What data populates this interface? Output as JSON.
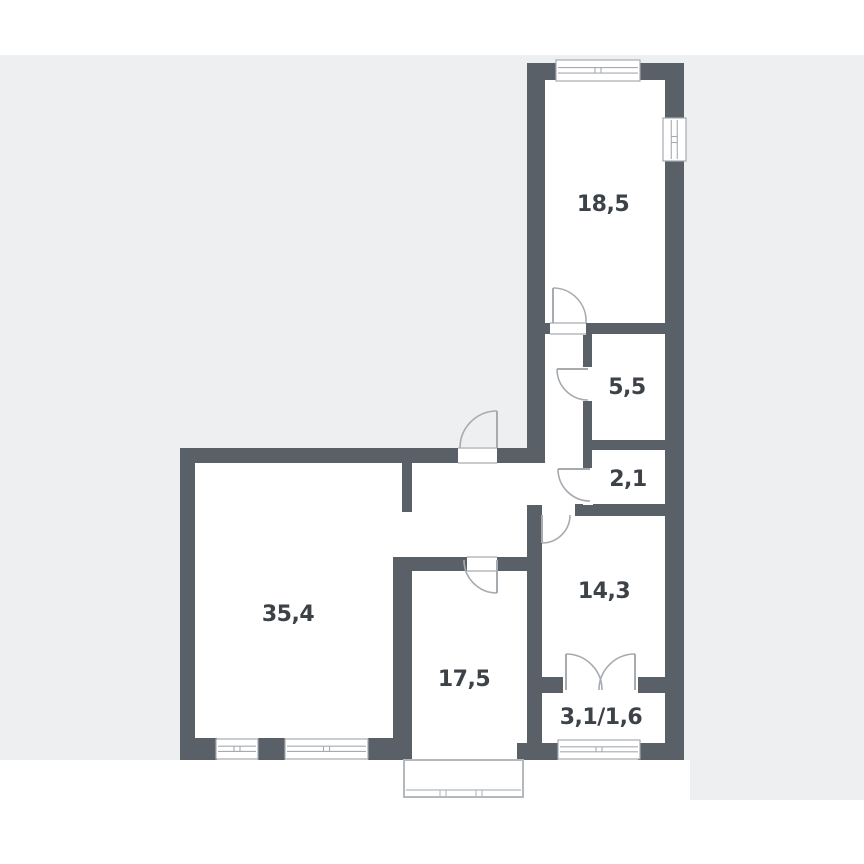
{
  "title": "apartment-floor-plan",
  "colors": {
    "canvas_gray": "#edeff0",
    "paper_white": "#ffffff",
    "wall": "#5a6067",
    "thin_line": "#a6abb0",
    "terrace_line": "#b3b8bc",
    "text": "#3d4248"
  },
  "rooms": [
    {
      "id": "room-18-5",
      "label": "18,5",
      "cx": 603,
      "cy": 211
    },
    {
      "id": "room-5-5",
      "label": "5,5",
      "cx": 627,
      "cy": 394
    },
    {
      "id": "room-2-1",
      "label": "2,1",
      "cx": 628,
      "cy": 486
    },
    {
      "id": "room-14-3",
      "label": "14,3",
      "cx": 604,
      "cy": 598
    },
    {
      "id": "balcony",
      "label": "3,1/1,6",
      "cx": 601,
      "cy": 724
    },
    {
      "id": "room-35-4",
      "label": "35,4",
      "cx": 288,
      "cy": 621
    },
    {
      "id": "hall-17-5",
      "label": "17,5",
      "cx": 464,
      "cy": 686
    }
  ],
  "label_font_px": 22,
  "geometry": {
    "bands": {
      "top_white": [
        0,
        0,
        864,
        55
      ],
      "canvas": [
        0,
        55,
        864,
        745
      ],
      "bottom_white": [
        0,
        800,
        864,
        64
      ],
      "under_building_white": [
        0,
        760,
        690,
        40
      ]
    },
    "interior": [
      [
        527,
        63,
        157,
        614
      ],
      [
        527,
        677,
        138,
        83
      ],
      [
        180,
        448,
        365,
        312
      ]
    ],
    "walls": [
      [
        527,
        63,
        30,
        17
      ],
      [
        640,
        63,
        44,
        17
      ],
      [
        665,
        63,
        19,
        57
      ],
      [
        665,
        160,
        19,
        600
      ],
      [
        527,
        63,
        18,
        400
      ],
      [
        497,
        448,
        48,
        15
      ],
      [
        180,
        448,
        278,
        15
      ],
      [
        180,
        448,
        15,
        312
      ],
      [
        180,
        738,
        37,
        22
      ],
      [
        258,
        738,
        27,
        22
      ],
      [
        368,
        738,
        44,
        22
      ],
      [
        393,
        557,
        19,
        203
      ],
      [
        402,
        463,
        10,
        49
      ],
      [
        393,
        557,
        74,
        14
      ],
      [
        497,
        557,
        30,
        14
      ],
      [
        527,
        505,
        15,
        238
      ],
      [
        527,
        323,
        23,
        11
      ],
      [
        585,
        323,
        80,
        11
      ],
      [
        583,
        333,
        9,
        35
      ],
      [
        583,
        400,
        9,
        69
      ],
      [
        583,
        440,
        82,
        10
      ],
      [
        575,
        504,
        90,
        12
      ],
      [
        542,
        677,
        21,
        16
      ],
      [
        638,
        677,
        27,
        16
      ],
      [
        517,
        743,
        41,
        17
      ],
      [
        638,
        743,
        32,
        17
      ]
    ],
    "door_gaps": [
      {
        "r": [
          458,
          447,
          39,
          17
        ],
        "threshold": true
      },
      {
        "r": [
          550,
          322,
          36,
          13
        ],
        "threshold": true
      },
      {
        "r": [
          583,
          367,
          10,
          34
        ],
        "threshold": false
      },
      {
        "r": [
          583,
          468,
          10,
          37
        ],
        "threshold": false
      },
      {
        "r": [
          542,
          503,
          33,
          14
        ],
        "threshold": false
      },
      {
        "r": [
          467,
          556,
          30,
          16
        ],
        "threshold": true
      },
      {
        "r": [
          563,
          676,
          75,
          18
        ],
        "threshold": false
      }
    ],
    "door_leaves": [
      [
        497,
        411,
        497,
        448
      ],
      [
        553,
        288,
        553,
        323
      ],
      [
        557,
        369,
        588,
        369
      ],
      [
        558,
        469,
        590,
        469
      ],
      [
        542,
        515,
        542,
        543
      ],
      [
        497,
        560,
        497,
        593
      ],
      [
        566,
        654,
        566,
        690
      ],
      [
        635,
        654,
        635,
        690
      ]
    ],
    "door_arcs": [
      "M497,411 A37,37 0 0 0 460,448",
      "M553,288 A33,33 0 0 1 586,323",
      "M557,369 A31,31 0 0 0 588,400",
      "M558,469 A32,32 0 0 0 590,501",
      "M542,543 A28,28 0 0 0 570,515",
      "M497,593 A33,33 0 0 1 464,560",
      "M566,654 A36,36 0 0 1 602,690",
      "M635,654 A36,36 0 0 0 599,690"
    ],
    "windows": [
      {
        "r": [
          556,
          60,
          84,
          21
        ],
        "orient": "h"
      },
      {
        "r": [
          663,
          118,
          23,
          43
        ],
        "orient": "v"
      },
      {
        "r": [
          558,
          740,
          82,
          19
        ],
        "orient": "h"
      },
      {
        "r": [
          216,
          739,
          42,
          20
        ],
        "orient": "h"
      },
      {
        "r": [
          285,
          739,
          83,
          20
        ],
        "orient": "h"
      }
    ],
    "terrace": {
      "outline": [
        404,
        760,
        119,
        37
      ],
      "sill_y": 790,
      "ticks_x": [
        443,
        479
      ]
    }
  }
}
